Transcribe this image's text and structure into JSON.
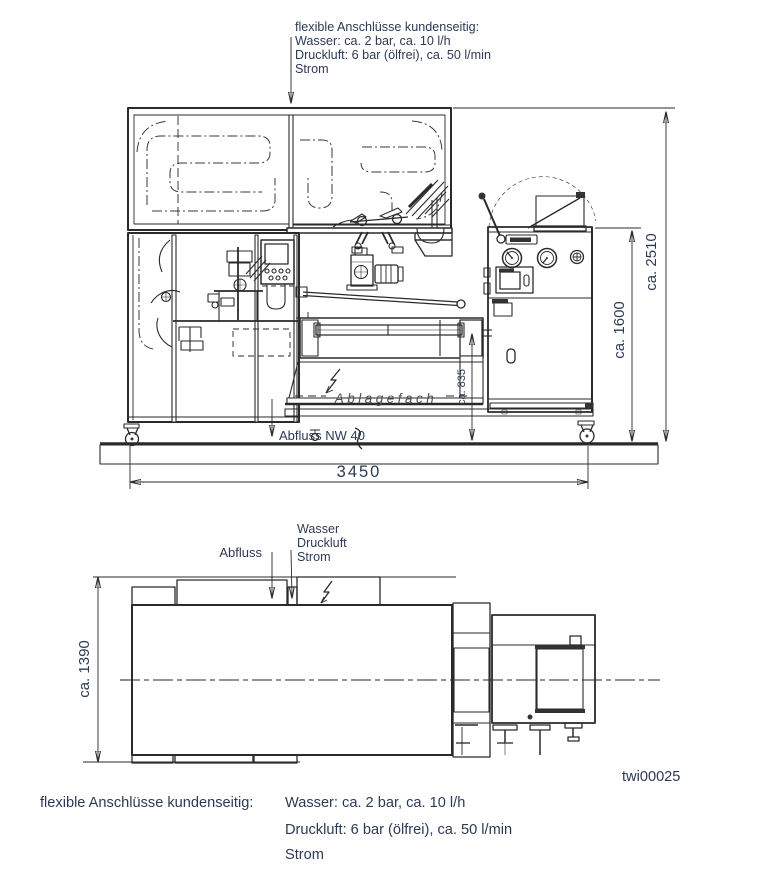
{
  "colors": {
    "background": "#ffffff",
    "line": "#2a2a2a",
    "text": "#2c3a55",
    "shelf_label": "#4a4f58"
  },
  "top_note": {
    "lines": [
      "flexible Anschlüsse kundenseitig:",
      "Wasser:  ca. 2 bar, ca. 10 l/h",
      "Druckluft: 6 bar (ölfrei), ca. 50 l/min",
      "Strom"
    ]
  },
  "front_view": {
    "shelf_label": "Ablagefach",
    "drain_label": "Abfluss NW 40",
    "dim_width": "3450",
    "dim_height_total": "ca. 2510",
    "dim_height_cabinet": "ca. 1600",
    "dim_height_outfeed": "ca. 835"
  },
  "plan_view": {
    "drain_label": "Abfluss",
    "connection_labels": [
      "Wasser",
      "Druckluft",
      "Strom"
    ],
    "dim_depth": "ca. 1390"
  },
  "drawing_number": "twi00025",
  "bottom_note": {
    "label": "flexible Anschlüsse kundenseitig:",
    "lines": [
      "Wasser: ca. 2 bar, ca. 10 l/h",
      "Druckluft: 6 bar (ölfrei), ca. 50 l/min",
      "Strom"
    ]
  }
}
